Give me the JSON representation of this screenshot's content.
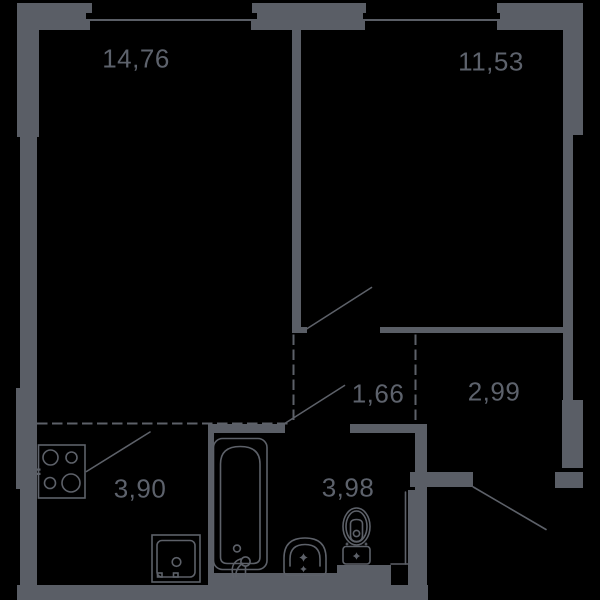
{
  "plan": {
    "background_color": "#000000",
    "wall_color": "#5a5e66",
    "line_color": "#5d6169",
    "text_color": "#5d626c",
    "rooms": [
      {
        "name": "living-room",
        "area": "14,76"
      },
      {
        "name": "bedroom",
        "area": "11,53"
      },
      {
        "name": "corridor",
        "area": "1,66"
      },
      {
        "name": "entry-hall",
        "area": "2,99"
      },
      {
        "name": "kitchen",
        "area": "3,90"
      },
      {
        "name": "bathroom",
        "area": "3,98"
      }
    ],
    "fixtures": [
      "stove-icon",
      "washing-machine-icon",
      "bathtub-icon",
      "sink-icon",
      "toilet-icon"
    ],
    "windows_count": 2,
    "door_swings_count": 3
  }
}
